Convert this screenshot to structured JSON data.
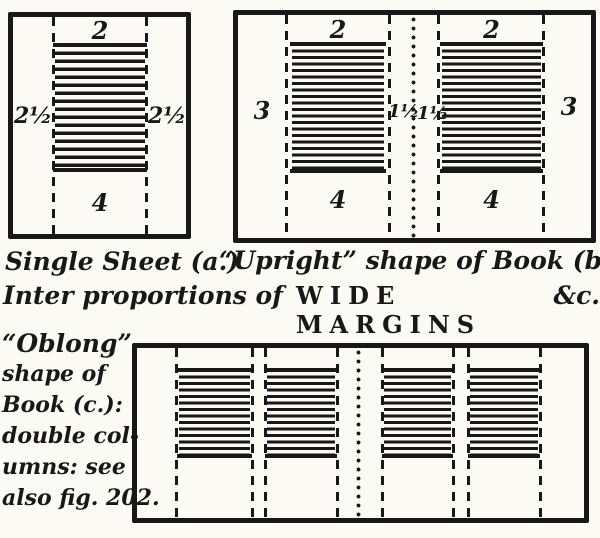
{
  "page": {
    "colors": {
      "ink": "#181818",
      "paper": "#fbfaf5"
    }
  },
  "captions": {
    "row1_left": "Single Sheet (a.)",
    "row1_right": "“Upright” shape of Book  (b.)",
    "row2_script": "Inter proportions of",
    "row2_caps": "WIDE MARGINS",
    "row2_tail": "&c."
  },
  "diagram_a": {
    "margins": {
      "top": "2",
      "left": "2½",
      "right": "2½",
      "bottom": "4"
    }
  },
  "diagram_b": {
    "margins": {
      "top_left_page": "2",
      "top_right_page": "2",
      "outer_left": "3",
      "outer_right": "3",
      "inner_left": "1½",
      "inner_right": "1½",
      "bottom_left_page": "4",
      "bottom_right_page": "4"
    }
  },
  "diagram_c": {
    "note_lines": [
      "“Oblong”",
      "shape of",
      "Book (c.):",
      "double col-",
      "umns: see",
      "also fig. 202."
    ]
  }
}
